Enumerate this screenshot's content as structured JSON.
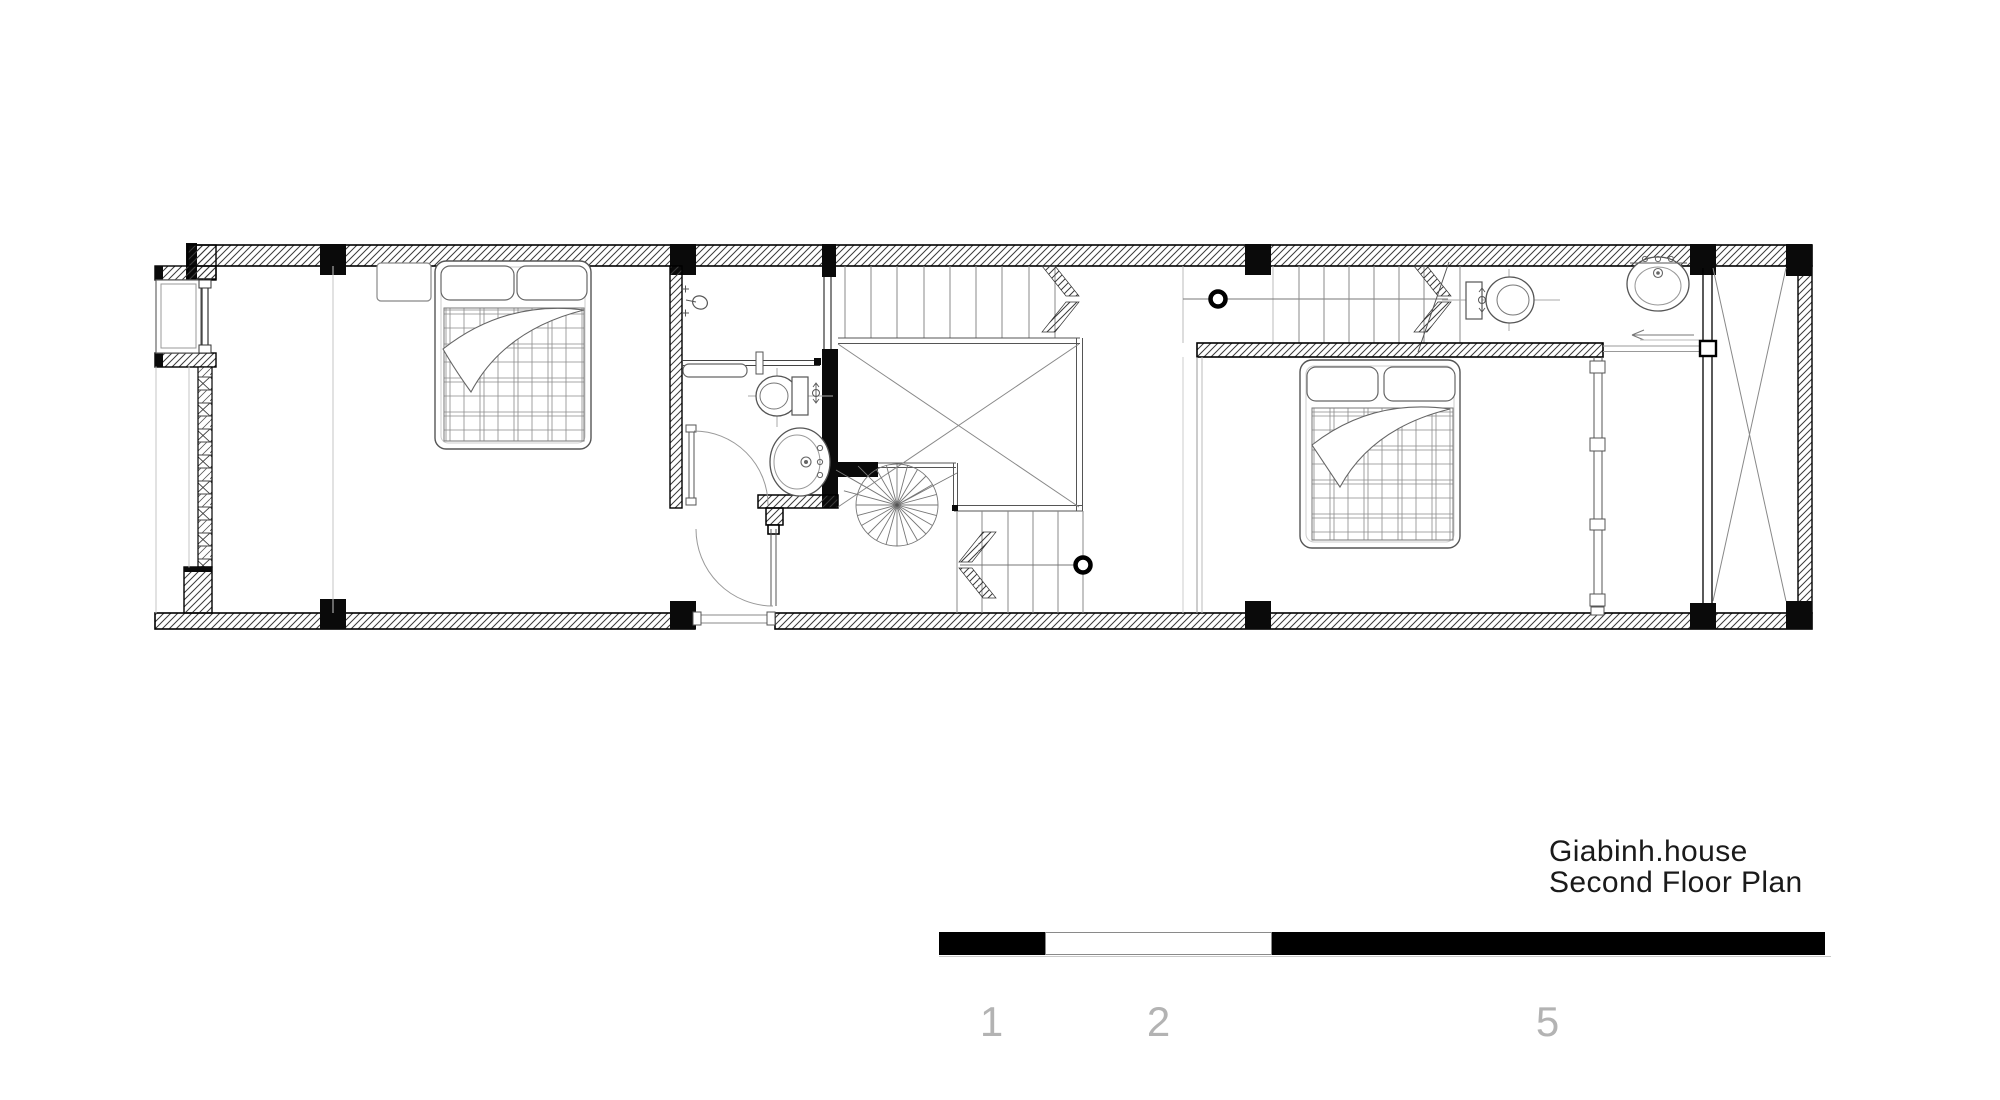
{
  "title": {
    "line1": "Giabinh.house",
    "line2": "Second Floor Plan"
  },
  "scale_bar": {
    "labels": {
      "first": "1",
      "second": "2",
      "third": "5"
    },
    "segments": [
      {
        "color": "#000000",
        "length_px": 106
      },
      {
        "color": "#ffffff",
        "length_px": 227
      },
      {
        "color": "#000000",
        "length_px": 553
      }
    ]
  },
  "colors": {
    "ink": "#1a1a1a",
    "wall_hatch": "#3a3a3a",
    "poche_black": "#0a0a0a",
    "light_line": "#c5c5c5",
    "fixture_line": "#666666",
    "scale_number_gray": "#b3b3b3",
    "background": "#ffffff"
  }
}
